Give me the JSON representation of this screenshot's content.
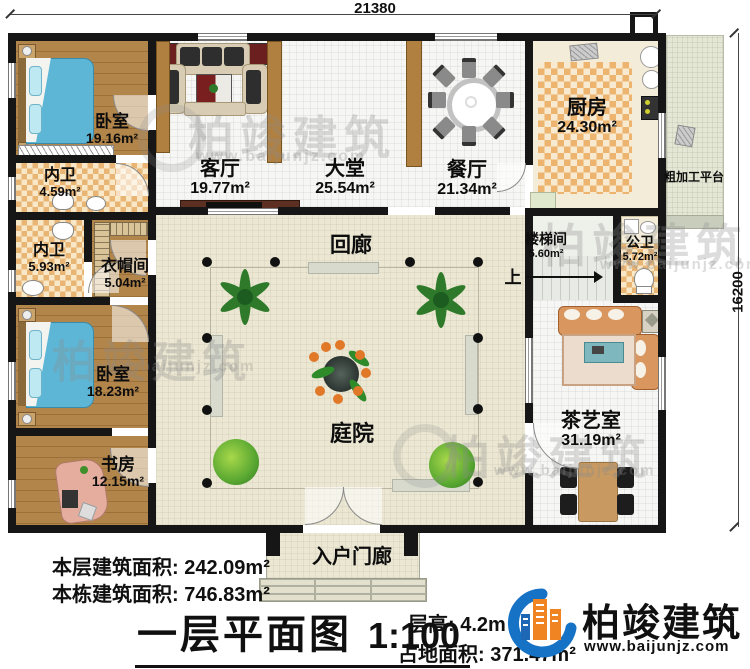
{
  "dimensions": {
    "top": "21380",
    "right": "16200"
  },
  "rooms": {
    "bedroom1": {
      "name": "卧室",
      "area": "19.16m²"
    },
    "bath1": {
      "name": "内卫",
      "area": "4.59m²"
    },
    "bath2": {
      "name": "内卫",
      "area": "5.93m²"
    },
    "cloakroom": {
      "name": "衣帽间",
      "area": "5.04m²"
    },
    "bedroom2": {
      "name": "卧室",
      "area": "18.23m²"
    },
    "study": {
      "name": "书房",
      "area": "12.15m²"
    },
    "living": {
      "name": "客厅",
      "area": "19.77m²"
    },
    "hall": {
      "name": "大堂",
      "area": "25.54m²"
    },
    "dining": {
      "name": "餐厅",
      "area": "21.34m²"
    },
    "kitchen": {
      "name": "厨房",
      "area": "24.30m²"
    },
    "stairwell": {
      "name": "楼梯间",
      "area": "5.60m²"
    },
    "public_wc": {
      "name": "公卫",
      "area": "5.72m²"
    },
    "tea_room": {
      "name": "茶艺室",
      "area": "31.19m²"
    },
    "corridor": {
      "name": "回廊"
    },
    "courtyard": {
      "name": "庭院"
    },
    "platform": {
      "name": "粗加工平台"
    },
    "porch": {
      "name": "入户门廊"
    },
    "stair_up": {
      "name": "上"
    }
  },
  "footer": {
    "floor_area_label": "本层建筑面积:",
    "floor_area_value": "242.09m²",
    "total_area_label": "本栋建筑面积:",
    "total_area_value": "746.83m²",
    "title": "一层平面图",
    "scale": "1:100",
    "height_label": "层高:",
    "height_value": "4.2m",
    "land_label": "占地面积:",
    "land_value": "371.47m²"
  },
  "brand": {
    "name": "柏竣建筑",
    "url": "www.baijunjz.com"
  },
  "watermark": {
    "text": "柏竣建筑",
    "url": "www.baijunjz.com"
  },
  "colors": {
    "accent_blue": "#1672c4",
    "accent_orange": "#f08423",
    "wall": "#161616"
  }
}
